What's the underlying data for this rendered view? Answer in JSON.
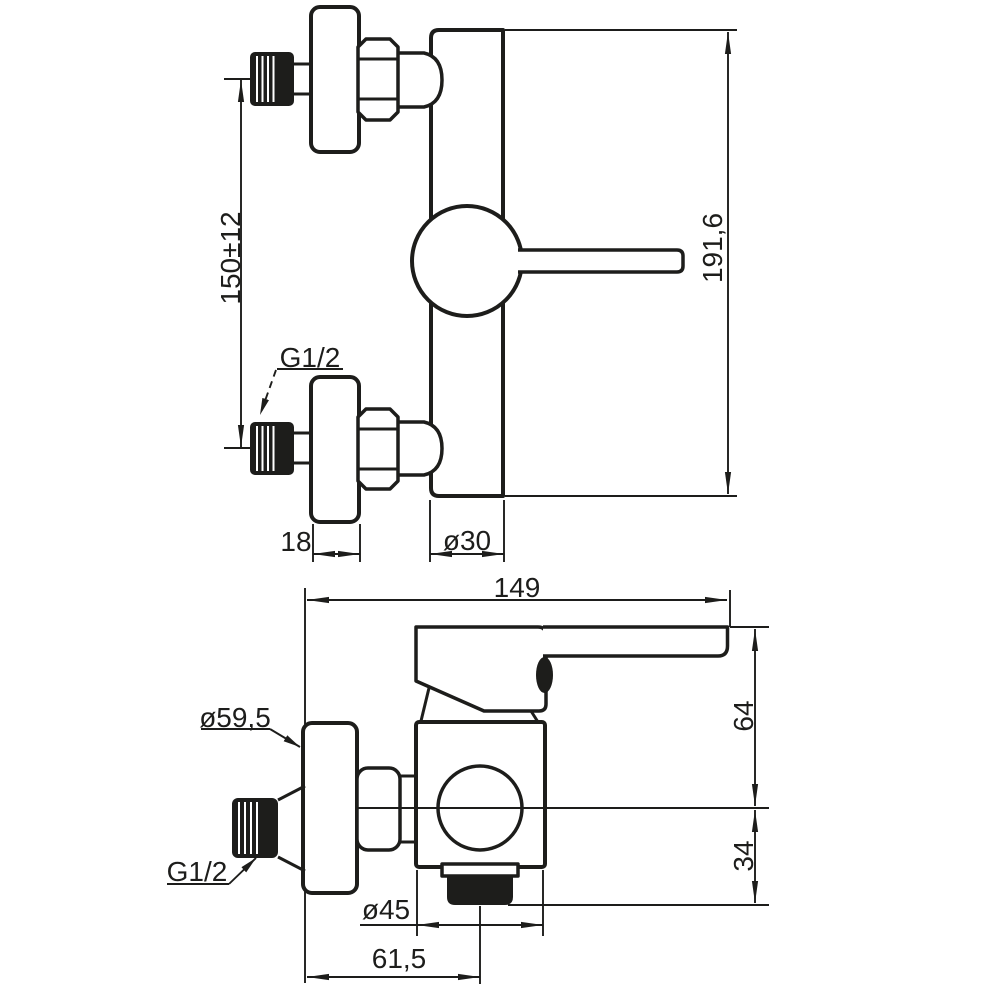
{
  "drawing": {
    "type": "technical-dimension-drawing",
    "subject": "wall-mounted single-lever shower mixer",
    "colors": {
      "line": "#1d1d1b",
      "background": "#ffffff"
    },
    "front": {
      "spacing": "150±12",
      "thread": "G1/2",
      "flange_depth": "18",
      "body_diameter": "ø30",
      "height": "191,6"
    },
    "side": {
      "depth": "149",
      "flange_diameter": "ø59,5",
      "thread": "G1/2",
      "handle_height": "64",
      "spout_drop": "34",
      "body_diameter": "ø45",
      "spout_offset": "61,5"
    }
  }
}
